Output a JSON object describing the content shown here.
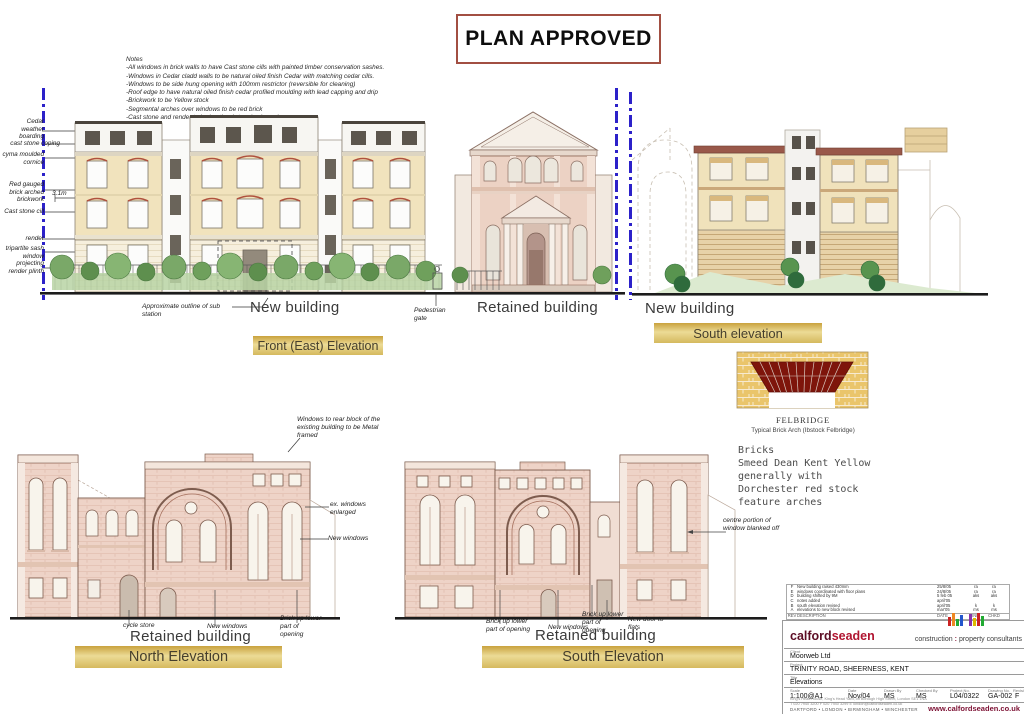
{
  "stamp": {
    "text": "PLAN APPROVED"
  },
  "notes": {
    "title": "Notes",
    "lines": [
      "-All windows in brick walls to have Cast stone cills with painted timber conservation sashes.",
      "-Windows in Cedar cladd walls to be natural oiled finish Cedar with matching cedar cills.",
      "-Windows to be side hung opening with 100mm restrictor (reversible  for cleaning)",
      "-Roof edge to have natural oiled finish cedar profiled moulding with lead capping and drip",
      "-Brickwork to be Yellow stock",
      "-Segmental arches over windows to be red brick",
      "-Cast stone and render to be 'portland stone' coloured"
    ]
  },
  "front_elevation": {
    "callouts": [
      "Cedar weather boarding",
      "cast stone coping",
      "cyma moulded cornice",
      "Red gauged brick arched brickwork",
      "Cast stone cill",
      "render",
      "tripartite sash window",
      "projecting render plinth"
    ],
    "dimension": "3.1m",
    "substation": "Approximate outline of sub station",
    "new_building": "New building",
    "pedestrian_gate": "Pedestrian gate",
    "retained_building": "Retained building",
    "title": "Front (East) Elevation"
  },
  "south_top": {
    "new_building": "New building",
    "title": "South elevation"
  },
  "brick_detail": {
    "name": "FELBRIDGE",
    "caption": "Typical Brick Arch (Ibstock Felbridge)",
    "notes": [
      "Bricks",
      "Smeed Dean Kent Yellow",
      "generally with",
      "Dorchester red stock",
      "feature arches"
    ]
  },
  "north_elevation": {
    "metal_framed": "Windows to rear block of the existing building to be Metal framed",
    "ex_windows": "ex. windows enlarged",
    "new_windows_mid": "New windows",
    "cycle_store": "cycle store",
    "new_windows": "New windows",
    "brick_up": "Brick up lower part of opening",
    "retained_building": "Retained building",
    "title": "North Elevation"
  },
  "south_bottom": {
    "brick_up_1": "Brick up lower part of opening",
    "new_windows": "New windows",
    "brick_up_2": "Brick up lower part of opening",
    "new_door": "New door to flats",
    "centre_portion": "centre portion of window blanked off",
    "retained_building": "Retained building",
    "title": "South Elevation"
  },
  "revision_table": {
    "rows": [
      {
        "rev": "F",
        "description": "New building raised 430mm",
        "date": "25/8/05",
        "init": "ra",
        "chkd": "ra"
      },
      {
        "rev": "E",
        "description": "windows coordinated with floor plans",
        "date": "24/8/05",
        "init": "ra",
        "chkd": "ra"
      },
      {
        "rev": "D",
        "description": "building shifted by 9M",
        "date": "5 feb 05",
        "init": "aks",
        "chkd": "aks"
      },
      {
        "rev": "C",
        "description": "notes added",
        "date": "april'05",
        "init": "",
        "chkd": ""
      },
      {
        "rev": "B",
        "description": "south elevation revised",
        "date": "april'05",
        "init": "k",
        "chkd": "k"
      },
      {
        "rev": "A",
        "description": "elevations to new block revised",
        "date": "mar'05",
        "init": "ms",
        "chkd": "ms"
      }
    ],
    "header": {
      "rev": "REV",
      "description": "DESCRIPTION",
      "date": "DATE",
      "init": "INIT",
      "chkd": "CHKD"
    }
  },
  "title_block": {
    "brand": {
      "bold": "calford",
      "light": "seaden"
    },
    "tagline": {
      "a": "construction",
      "sep": ":",
      "b": "property consultants"
    },
    "labels": {
      "client": "Client",
      "project": "Project",
      "title": "Title",
      "scale": "Scale",
      "date": "Date",
      "drawn": "Drawn By",
      "checked": "Checked By",
      "project_no": "Project No.",
      "drawing_no": "Drawing No.",
      "revision": "Revision"
    },
    "client": "Moorweb Ltd",
    "project": "TRINITY ROAD, SHEERNESS, KENT",
    "title": "Elevations",
    "scale": "1:100@A1",
    "date": "Nov/04",
    "drawn": "MS",
    "checked": "MS",
    "project_no": "L04/0322",
    "drawing_no": "GA-002",
    "revision": "F",
    "address": "King's Head House, King's Head Yard, off Borough High Street, London SE1 1NA",
    "contact": "T 020 7940 3200    F 020 7940 3299    E london@calfordseaden.co.uk",
    "offices": "DARTFORD  •  LONDON  •  BIRMINGHAM  •  WINCHESTER",
    "website": "www.calfordseaden.co.uk"
  }
}
